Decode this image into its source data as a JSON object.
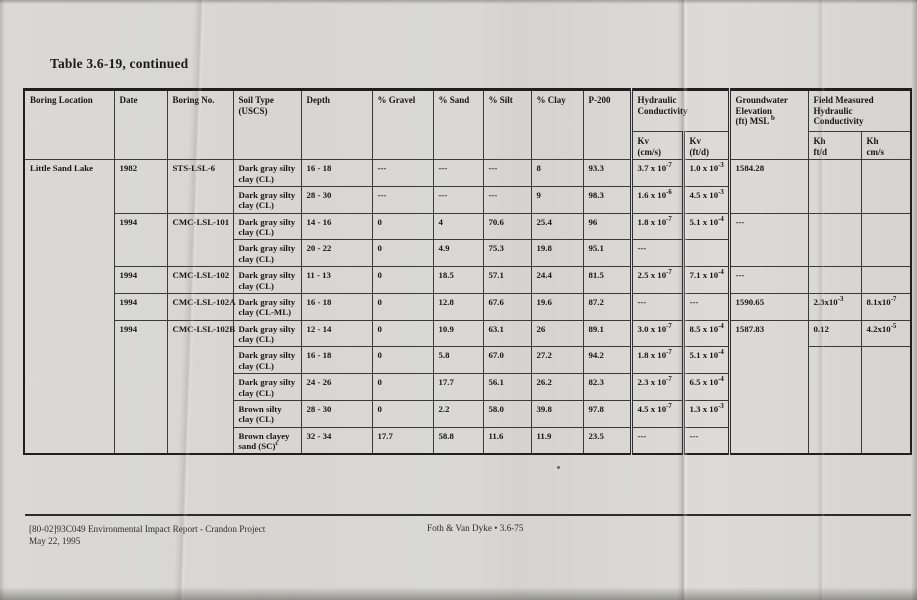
{
  "page": {
    "title": "Table 3.6-19, continued",
    "footer": {
      "doc_line": "[80-02]93C049  Environmental Impact Report - Crandon Project",
      "date_line": "May 22, 1995",
      "page_ref": "Foth & Van Dyke  •  3.6-75"
    }
  },
  "table": {
    "headers": {
      "boring_location": "Boring Location",
      "date": "Date",
      "boring_no": "Boring No.",
      "soil_type": "Soil Type\n(USCS)",
      "depth": "Depth",
      "gravel": "% Gravel",
      "sand": "% Sand",
      "silt": "% Silt",
      "clay": "% Clay",
      "p200": "P-200",
      "hydraulic_conductivity": "Hydraulic Conductivity",
      "kv_cms": "Kv\n(cm/s)",
      "kv_ftd": "Kv\n(ft/d)",
      "groundwater": {
        "t": "Groundwater\nElevation\n(ft) MSL ",
        "sup": "b"
      },
      "field_measured": "Field Measured\nHydraulic\nConductivity",
      "kh_ftd": "Kh\nft/d",
      "kh_cms": "Kh\ncm/s"
    },
    "rows": [
      {
        "location": "Little Sand Lake",
        "date": "1982",
        "boring_no": "STS-LSL-6",
        "soil": {
          "t": "Dark gray silty clay (CL)",
          "sup": ""
        },
        "depth": "16 - 18",
        "gravel": "---",
        "sand": "---",
        "silt": "---",
        "clay": "8",
        "p200": "93.3",
        "kv_cms": {
          "m": "3.7 x 10",
          "e": "-7"
        },
        "kv_ftd": {
          "m": "1.0 x 10",
          "e": "-3"
        },
        "gw": "1584.28",
        "kh_ftd": {
          "m": "",
          "e": ""
        },
        "kh_cms": {
          "m": "",
          "e": ""
        }
      },
      {
        "soil": {
          "t": "Dark gray silty clay (CL)",
          "sup": ""
        },
        "depth": "28 - 30",
        "gravel": "---",
        "sand": "---",
        "silt": "---",
        "clay": "9",
        "p200": "98.3",
        "kv_cms": {
          "m": "1.6 x 10",
          "e": "-6"
        },
        "kv_ftd": {
          "m": "4.5 x 10",
          "e": "-3"
        }
      },
      {
        "date": "1994",
        "boring_no": "CMC-LSL-101",
        "soil": {
          "t": "Dark gray silty clay (CL)",
          "sup": ""
        },
        "depth": "14 - 16",
        "gravel": "0",
        "sand": "4",
        "silt": "70.6",
        "clay": "25.4",
        "p200": "96",
        "kv_cms": {
          "m": "1.8 x 10",
          "e": "-7"
        },
        "kv_ftd": {
          "m": "5.1 x 10",
          "e": "-4"
        },
        "gw": "---",
        "kh_ftd": {
          "m": "",
          "e": ""
        },
        "kh_cms": {
          "m": "",
          "e": ""
        }
      },
      {
        "soil": {
          "t": "Dark gray silty clay (CL)",
          "sup": ""
        },
        "depth": "20 - 22",
        "gravel": "0",
        "sand": "4.9",
        "silt": "75.3",
        "clay": "19.8",
        "p200": "95.1",
        "kv_cms": {
          "m": "---",
          "e": ""
        },
        "kv_ftd": {
          "m": "",
          "e": ""
        }
      },
      {
        "date": "1994",
        "boring_no": "CMC-LSL-102",
        "soil": {
          "t": "Dark gray silty clay (CL)",
          "sup": ""
        },
        "depth": "11 - 13",
        "gravel": "0",
        "sand": "18.5",
        "silt": "57.1",
        "clay": "24.4",
        "p200": "81.5",
        "kv_cms": {
          "m": "2.5 x 10",
          "e": "-7"
        },
        "kv_ftd": {
          "m": "7.1 x 10",
          "e": "-4"
        },
        "gw": "---",
        "kh_ftd": {
          "m": "",
          "e": ""
        },
        "kh_cms": {
          "m": "",
          "e": ""
        }
      },
      {
        "date": "1994",
        "boring_no": "CMC-LSL-102A",
        "soil": {
          "t": "Dark gray silty clay (CL-ML)",
          "sup": ""
        },
        "depth": "16 - 18",
        "gravel": "0",
        "sand": "12.8",
        "silt": "67.6",
        "clay": "19.6",
        "p200": "87.2",
        "kv_cms": {
          "m": "---",
          "e": ""
        },
        "kv_ftd": {
          "m": "---",
          "e": ""
        },
        "gw": "1590.65",
        "kh_ftd": {
          "m": "2.3x10",
          "e": "-3"
        },
        "kh_cms": {
          "m": "8.1x10",
          "e": "-7"
        }
      },
      {
        "date": "1994",
        "boring_no": "CMC-LSL-102B",
        "soil": {
          "t": "Dark gray silty clay (CL)",
          "sup": ""
        },
        "depth": "12 - 14",
        "gravel": "0",
        "sand": "10.9",
        "silt": "63.1",
        "clay": "26",
        "p200": "89.1",
        "kv_cms": {
          "m": "3.0 x 10",
          "e": "-7"
        },
        "kv_ftd": {
          "m": "8.5 x 10",
          "e": "-4"
        },
        "gw": "1587.83",
        "kh_ftd": {
          "m": "0.12",
          "e": ""
        },
        "kh_cms": {
          "m": "4.2x10",
          "e": "-5"
        }
      },
      {
        "soil": {
          "t": "Dark gray silty clay (CL)",
          "sup": ""
        },
        "depth": "16 - 18",
        "gravel": "0",
        "sand": "5.8",
        "silt": "67.0",
        "clay": "27.2",
        "p200": "94.2",
        "kv_cms": {
          "m": "1.8 x 10",
          "e": "-7"
        },
        "kv_ftd": {
          "m": "5.1 x 10",
          "e": "-4"
        },
        "kh_ftd": {
          "m": "",
          "e": ""
        },
        "kh_cms": {
          "m": "",
          "e": ""
        }
      },
      {
        "soil": {
          "t": "Dark gray silty clay (CL)",
          "sup": ""
        },
        "depth": "24 - 26",
        "gravel": "0",
        "sand": "17.7",
        "silt": "56.1",
        "clay": "26.2",
        "p200": "82.3",
        "kv_cms": {
          "m": "2.3 x 10",
          "e": "-7"
        },
        "kv_ftd": {
          "m": "6.5 x 10",
          "e": "-4"
        }
      },
      {
        "soil": {
          "t": "Brown silty clay (CL)",
          "sup": ""
        },
        "depth": "28 - 30",
        "gravel": "0",
        "sand": "2.2",
        "silt": "58.0",
        "clay": "39.8",
        "p200": "97.8",
        "kv_cms": {
          "m": "4.5 x 10",
          "e": "-7"
        },
        "kv_ftd": {
          "m": "1.3 x 10",
          "e": "-3"
        }
      },
      {
        "soil": {
          "t": "Brown clayey sand (SC)",
          "sup": "c"
        },
        "depth": "32 - 34",
        "gravel": "17.7",
        "sand": "58.8",
        "silt": "11.6",
        "clay": "11.9",
        "p200": "23.5",
        "kv_cms": {
          "m": "---",
          "e": ""
        },
        "kv_ftd": {
          "m": "---",
          "e": ""
        }
      }
    ]
  }
}
